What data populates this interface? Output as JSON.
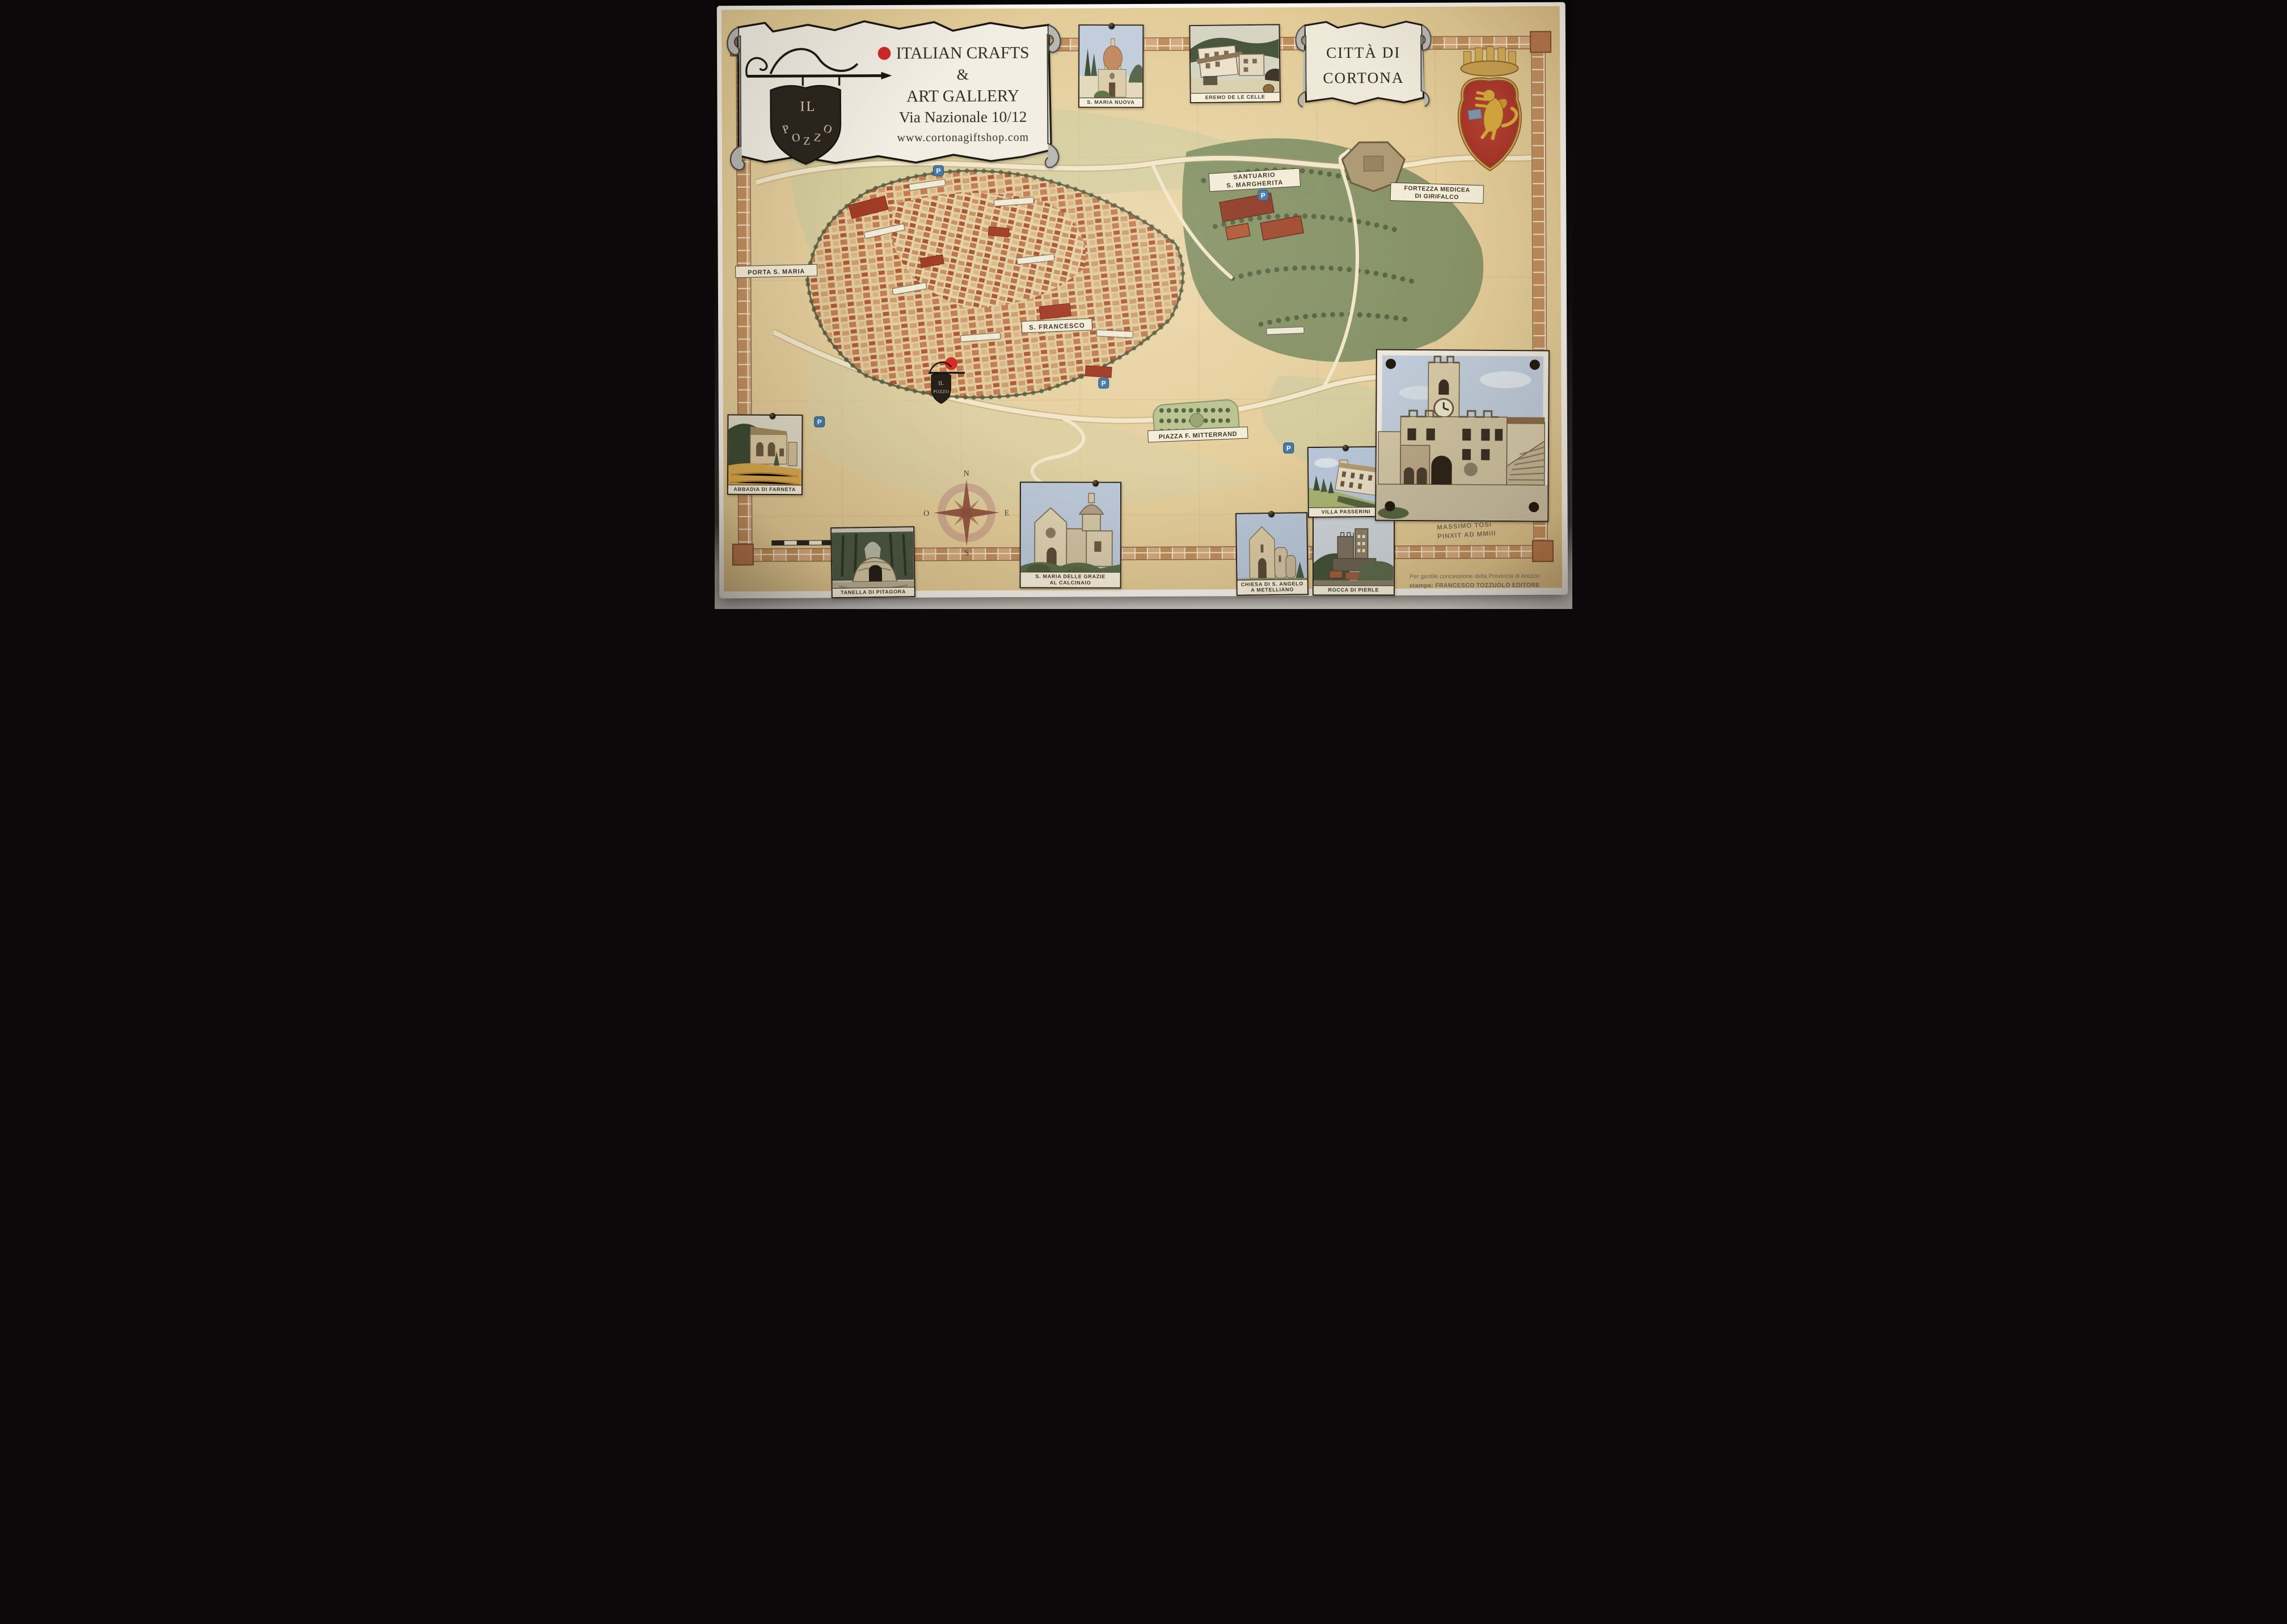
{
  "banner": {
    "shield": {
      "top": "IL",
      "bottom": [
        "P",
        "O",
        "Z",
        "Z",
        "O"
      ]
    },
    "heading": "ITALIAN CRAFTS",
    "ampersand": "&",
    "heading2": "ART GALLERY",
    "address": "Via Nazionale 10/12",
    "website": "www.cortonagiftshop.com",
    "dot_color": "#cf2a28"
  },
  "title_scroll": {
    "line1": "CITTÀ DI",
    "line2": "CORTONA"
  },
  "coat_of_arms": {
    "name": "Cortona coat of arms",
    "shield_color": "#a8352a",
    "lion_color": "#d8a93e"
  },
  "vignettes": [
    {
      "id": "s-maria-nuova",
      "caption": "S. MARIA NUOVA"
    },
    {
      "id": "eremo-le-celle",
      "caption": "EREMO DE LE CELLE"
    },
    {
      "id": "abbadia-di-farneta",
      "caption": "ABBADIA DI FARNETA"
    },
    {
      "id": "tanella-di-pitagora",
      "caption": "TANELLA DI PITAGORA"
    },
    {
      "id": "calcinaio",
      "caption_line1": "S. MARIA DELLE GRAZIE",
      "caption_line2": "AL CALCINAIO"
    },
    {
      "id": "s-angelo-metelliano",
      "caption_line1": "CHIESA DI S. ANGELO",
      "caption_line2": "A METELLIANO"
    },
    {
      "id": "rocca-di-pierle",
      "caption": "ROCCA DI PIERLE"
    },
    {
      "id": "villa-passerini",
      "caption": "VILLA PASSERINI"
    }
  ],
  "artist_note": {
    "line1": "MASSIMO TOSI",
    "line2": "PINXIT AD MMIII"
  },
  "map": {
    "labels": [
      {
        "line1": "SANTUARIO",
        "line2": "S. MARGHERITA"
      },
      {
        "line1": "FORTEZZA MEDICEA",
        "line2": "DI GIRIFALCO"
      },
      {
        "line1": "S. FRANCESCO"
      },
      {
        "line1": "PIAZZA F. MITTERRAND"
      },
      {
        "line1": "PORTA S. MARIA"
      }
    ],
    "marker": {
      "line1": "IL",
      "line2": "POZZO"
    },
    "parking_symbol": "P",
    "compass": {
      "north": "N",
      "south": "S",
      "west": "O",
      "east": "E"
    }
  },
  "credits": {
    "line1": "Per gentile concessione della Provincia di Arezzo",
    "line2": "stampa: FRANCESCO TOZZUOLO EDITORE"
  }
}
